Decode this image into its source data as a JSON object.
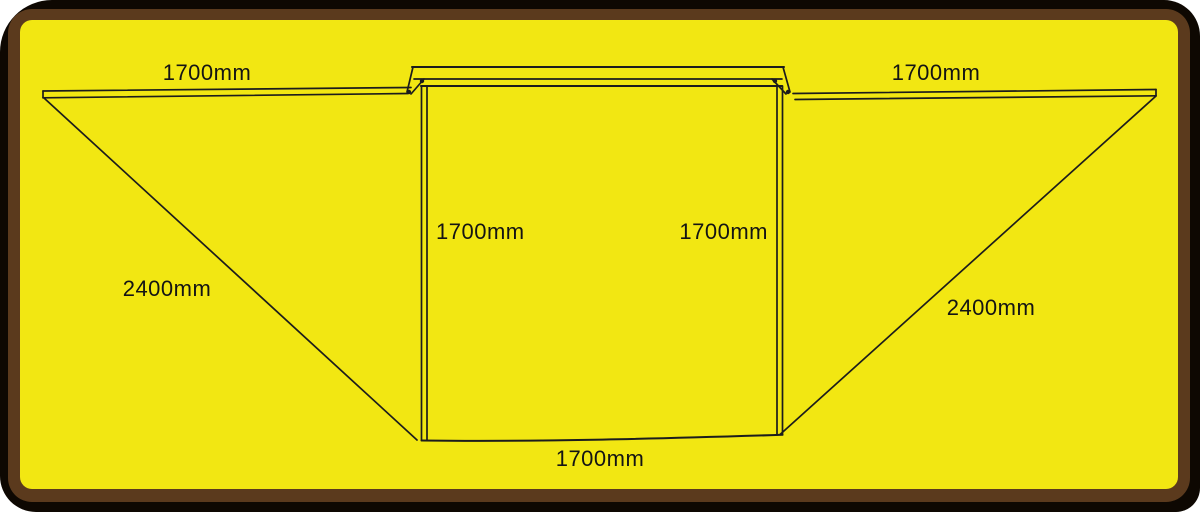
{
  "diagram": {
    "type": "awning-top-view-dimension-drawing",
    "labels": {
      "wing_left_top": "1700mm",
      "wing_right_top": "1700mm",
      "body_left_side": "1700mm",
      "body_right_side": "1700mm",
      "body_bottom": "1700mm",
      "diagonal_left": "2400mm",
      "diagonal_right": "2400mm"
    },
    "colors": {
      "canvas_yellow": "#f2e712",
      "frame_brown": "#5b3a1d",
      "edge_black": "#0e0802",
      "line_ink": "#1c1c1c"
    }
  }
}
